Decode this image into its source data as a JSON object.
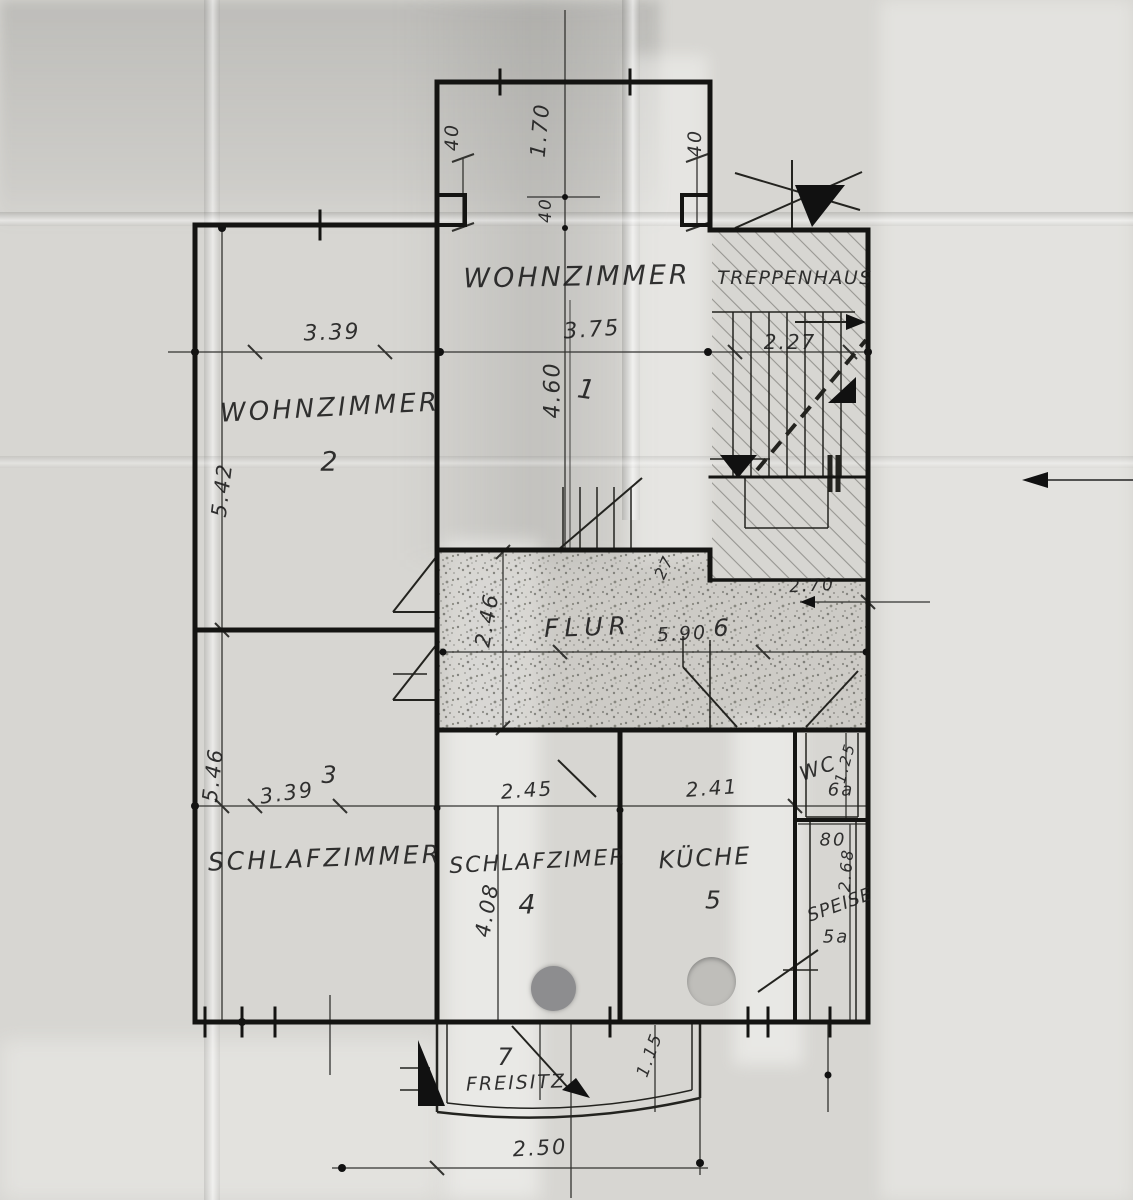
{
  "document": {
    "type": "hand-drawn floor plan, scanned creased paper",
    "ink_color": "#1a1a1a",
    "paper_color": "#d7d6d2"
  },
  "rooms": {
    "wohnzimmer1": {
      "name": "WOHNZIMMER",
      "number": "1"
    },
    "wohnzimmer2": {
      "name": "WOHNZIMMER",
      "number": "2"
    },
    "schlafzimmer3": {
      "name": "SCHLAFZIMMER",
      "number": "3"
    },
    "schlafzimmer4": {
      "name": "SCHLAFZIMER",
      "number": "4"
    },
    "kueche": {
      "name": "KÜCHE",
      "number": "5"
    },
    "speise": {
      "name": "SPEISE",
      "number": "5a"
    },
    "flur": {
      "name": "FLUR",
      "number": "6"
    },
    "wc": {
      "name": "WC",
      "number": "6a"
    },
    "freisitz": {
      "name": "FREISITZ",
      "number": "7"
    },
    "treppenhaus": {
      "name": "TREPPENHAUS"
    }
  },
  "dimensions": {
    "bay_left": "40",
    "bay_depth": "1.70",
    "bay_step": "40",
    "bay_right": "40",
    "wz1_width": "3.75",
    "wz1_depth": "4.60",
    "wz2_width": "3.39",
    "wz2_depth": "5.42",
    "treppenhaus_width": "2.27",
    "flur_length": "5.90",
    "flur_width": "2.46",
    "flur_right_width": "2.70",
    "wall_thickness": "27",
    "sz3_width": "3.39",
    "sz3_depth": "5.46",
    "sz4_width": "2.45",
    "sz4_depth": "4.08",
    "kueche_width": "2.41",
    "wc_depth": "1.25",
    "speise_width": "80",
    "speise_depth": "2.68",
    "freisitz_width": "2.50",
    "freisitz_depth": "1.15"
  }
}
